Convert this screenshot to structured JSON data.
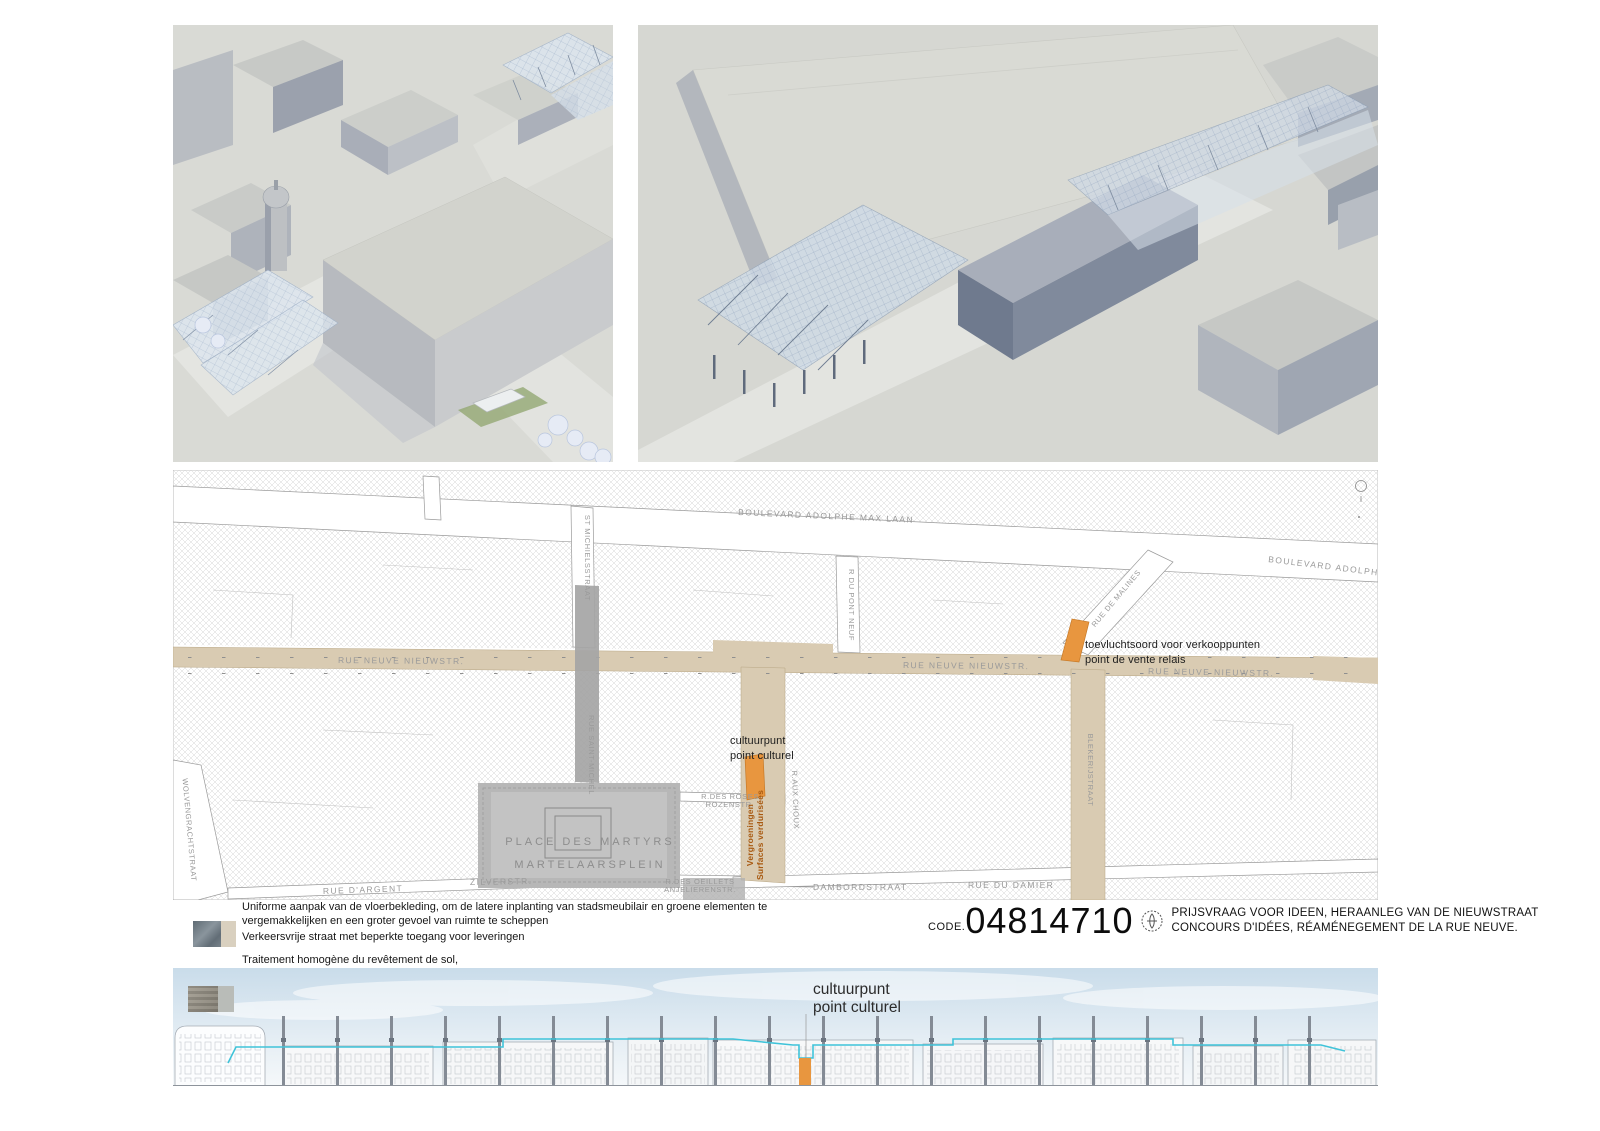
{
  "board": {
    "code_label": "CODE.",
    "code_number": "04814710",
    "title_nl": "PRIJSVRAAG VOOR IDEEN, HERAANLEG VAN DE NIEUWSTRAAT",
    "title_fr": "CONCOURS D'IDÉES, RÉAMÉNEGEMENT DE LA RUE NEUVE."
  },
  "legend": {
    "nl_1": "Uniforme aanpak van de vloerbekleding, om de latere inplanting van stadsmeubilair en groene elementen te vergemakkelijken en een groter gevoel van ruimte te scheppen",
    "nl_2": "Verkeersvrije straat met beperkte toegang voor leveringen",
    "fr_1": "Traitement homogène du revêtement de sol,",
    "fr_2": "facilitant l'intégration future de mobiliers urbains et d'éléments verdurisés et donnant l'impression de disposer de davantage d'espace",
    "fr_3": "Piétonnier à accès restreint pour les véhicules de livraison"
  },
  "map": {
    "streets": {
      "boulevard_laan": "BOULEVARD ADOLPHE MAX LAAN",
      "boulevard_max": "BOULEVARD ADOLPHE MAX",
      "rue_neuve": "RUE NEUVE  NIEUWSTR.",
      "st_michielsstraat": "ST MICHIELSSTRAAT",
      "rue_saint_michel": "RUE SAINT-MICHEL",
      "pont_neuf": "R DU PONT NEUF",
      "rue_de_malines": "RUE DE MALINES",
      "blekerijstraat": "BLEKERIJSTRAAT",
      "wolvengrachtstraat": "WOLVENGRACHTSTRAAT",
      "rue_dargent": "RUE D'ARGENT",
      "zilverstr": "ZILVERSTR.",
      "roses_1": "R.DES ROSES",
      "roses_2": "ROZENSTR.",
      "place_des_martyrs": "PLACE DES MARTYRS",
      "martelaarsplein": "MARTELAARSPLEIN",
      "oeillets_1": "R.DES OEILLETS",
      "oeillets_2": "ANJELIERENSTR.",
      "dambordstraat": "DAMBORDSTRAAT",
      "rue_du_damier": "RUE DU DAMIER",
      "rue_aux_choux": "R.AUX CHOUX"
    },
    "annotations": {
      "refuge_nl": "toevluchtsoord voor verkooppunten",
      "refuge_fr": "point de vente relais",
      "culture_nl": "cultuurpunt",
      "culture_fr": "point culturel",
      "green_nl": "Vergroeningen",
      "green_fr": "Surfaces verdurisées"
    },
    "accent_orange": "#e8963f",
    "street_beige": "#d9cbb2",
    "square_gray": "#b7b7b7"
  },
  "elevation": {
    "label_nl": "cultuurpunt",
    "label_fr": "point culturel",
    "canopy_line_color": "#3fc3d9"
  }
}
